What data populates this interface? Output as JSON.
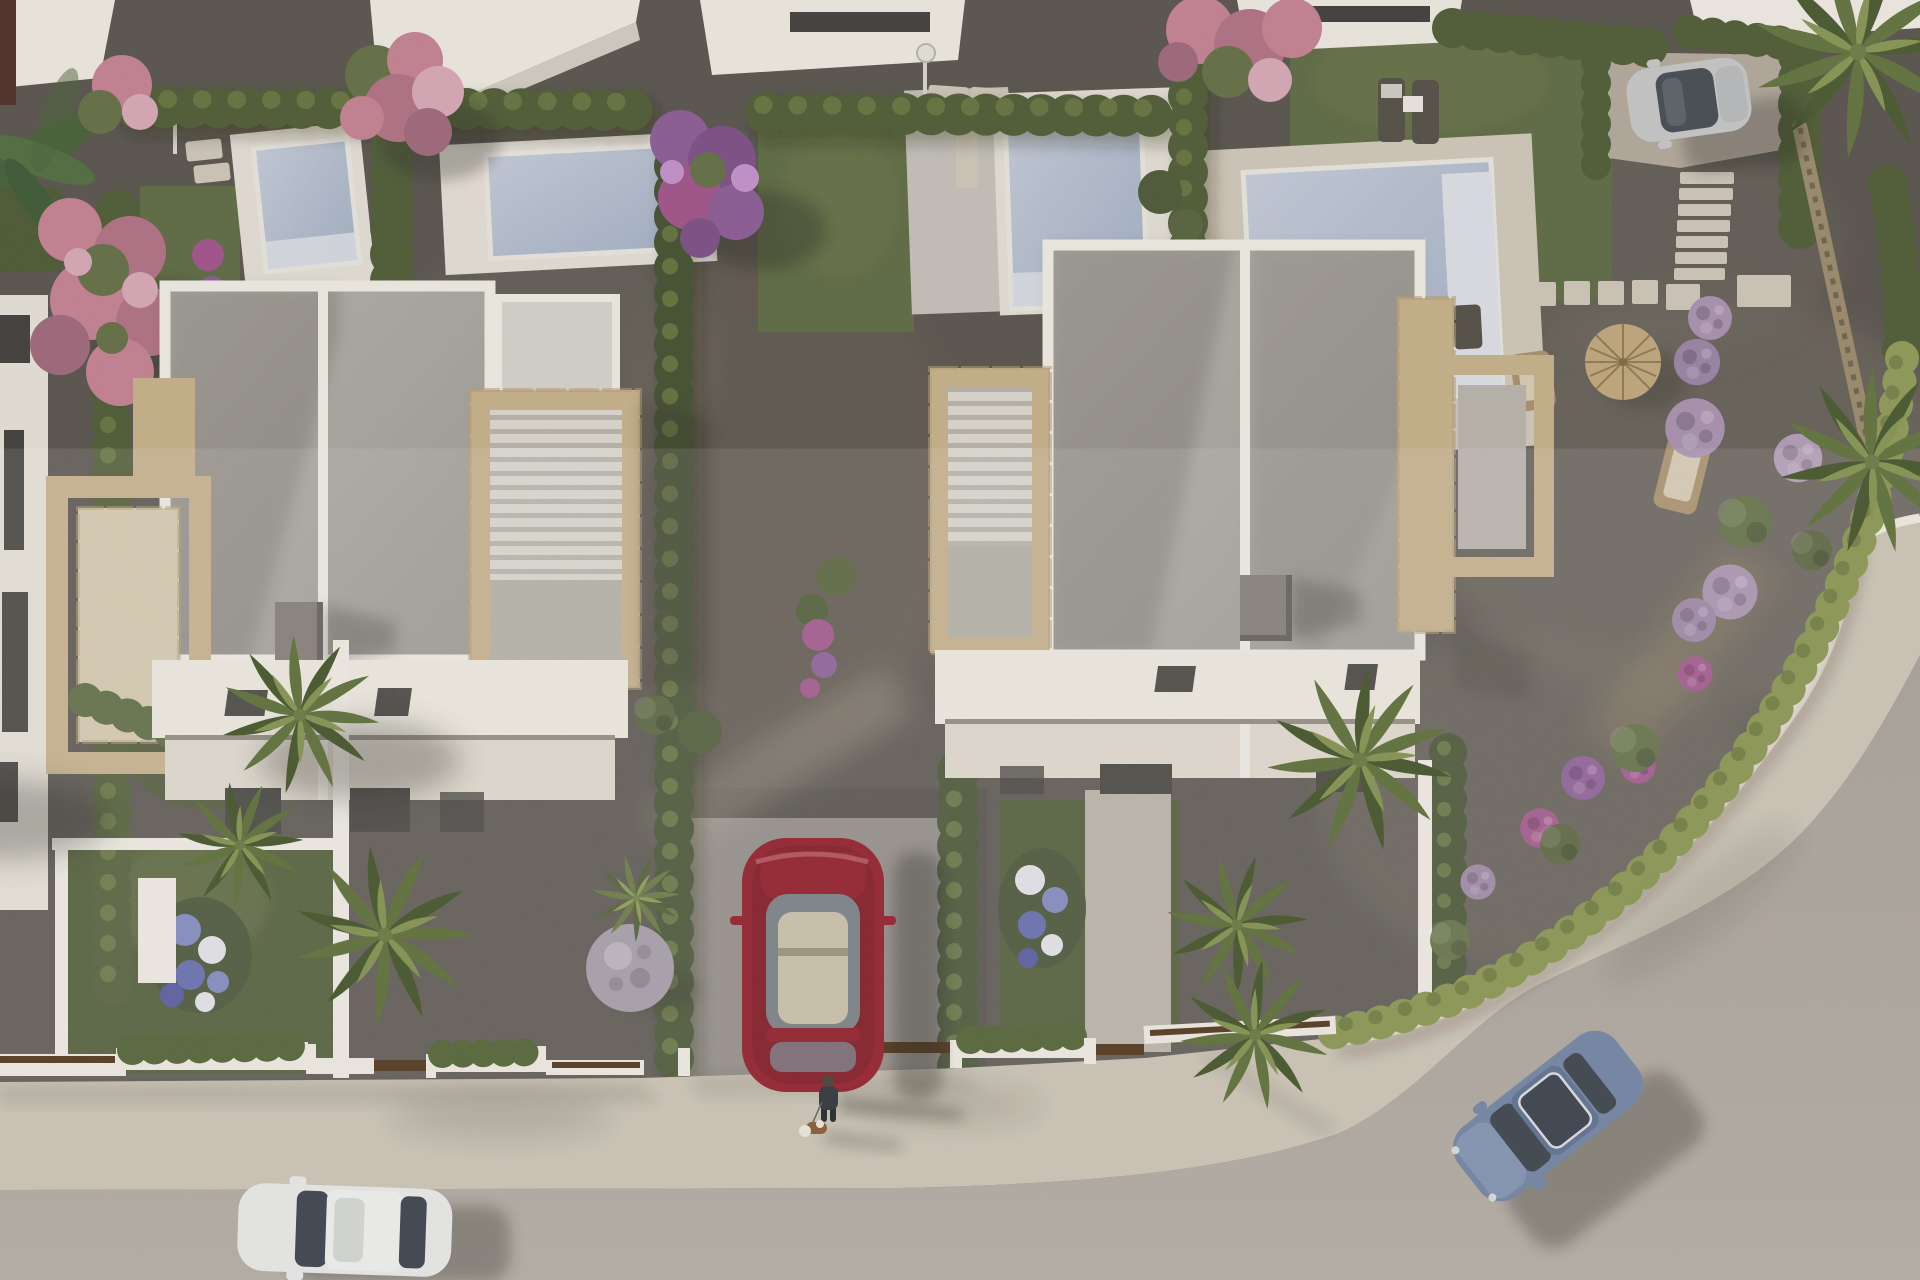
{
  "meta": {
    "title": "Aerial 3D architectural rendering of a modern villa development",
    "view": "top-down aerial, late-afternoon sun from the left, shadows cast to the right",
    "image_kind": "photorealistic CGI render, no text or UI elements visible"
  },
  "colors": {
    "gravel": "#54504a",
    "gravel_light": "#6a655c",
    "gravel_warm": "#60594e",
    "grass": "#5a683f",
    "grass_dark": "#47552f",
    "grass_light": "#6e7c49",
    "hedge": "#4a5931",
    "hedge_light": "#67793f",
    "curve_hedge": "#8d9a55",
    "cypress": "#3e4c2c",
    "deck_white": "#e7e3da",
    "deck_gray": "#c6c3bc",
    "deck_trav": "#d2cabb",
    "water": "#a2b0c6",
    "water_light": "#c6cedd",
    "water_step": "#dfe3ea",
    "wall_white": "#f4f1ea",
    "wall_shadow": "#d4cfc5",
    "roof_gravel": "#b5b2ac",
    "roof_dark": "#9b9893",
    "parapet": "#f3f0e9",
    "stone": "#c8b28a",
    "stone_light": "#dcc9a3",
    "stone_dark": "#a08b66",
    "facade": "#f2eee5",
    "terrace": "#e2dcd1",
    "glass": "#3b3a36",
    "chimney_top": "#7d7770",
    "chimney_side": "#585450",
    "road": "#aba49d",
    "road_light": "#b6b0a8",
    "sidewalk": "#cac3b4",
    "car_red": "#96212f",
    "car_red_dark": "#6e1722",
    "car_white": "#edefee",
    "car_blue": "#7387a9",
    "car_silver": "#c7c9ca",
    "glass_dark": "#3a424e",
    "interior_tan": "#cfc6b0",
    "pink": "#c67f92",
    "pink_light": "#dba9b9",
    "purple": "#8a5796",
    "lilac": "#a891b2",
    "magenta": "#a04f8a",
    "blue_flower": "#7b84c0",
    "white_flower": "#e6e6ee",
    "straw": "#c2a77b",
    "wood": "#a98f68",
    "gate_brown": "#53381f",
    "palm": "#5d7038",
    "palm_light": "#849650",
    "palm_dark": "#43552a",
    "person": "#30343d",
    "dog_brown": "#8a5c33",
    "ball_plant": "#a29aa8"
  },
  "scene": {
    "villas": [
      {
        "name": "left-villa",
        "style": "white modern flat roof, two units, gravel roof, travertine side terraces, pergola, rooftop chimney and skylights"
      },
      {
        "name": "right-villa",
        "style": "white modern flat roof, two units, gravel roof, travertine side terraces, rooftop chimney and skylights"
      }
    ],
    "pools": {
      "count": 4,
      "positions": [
        "top-left plot",
        "second top plot",
        "center-top plot",
        "top-right plot"
      ],
      "water": "light blue-grey with white steps",
      "decks": "white and travertine surrounds"
    },
    "vehicles": [
      {
        "name": "white-car",
        "state": "driving on the street, bottom-left"
      },
      {
        "name": "red-car",
        "state": "parked in central driveway between hedges"
      },
      {
        "name": "blue-car",
        "state": "driving on the curved street, bottom-right"
      },
      {
        "name": "silver-car",
        "state": "parked on driveway, top-right"
      }
    ],
    "pedestrians": [
      {
        "name": "person-walking-dog",
        "position": "sidewalk bottom-center",
        "shadow": "long, pointing right"
      }
    ],
    "vegetation": {
      "palm_trees": 8,
      "flowering_trees": [
        "pink tree top-left",
        "pink tree top-center",
        "purple tree center-top",
        "pink tree top-right"
      ],
      "hedges": "clipped boundary hedges between plots and along curved corner",
      "flower_bushes": "lilac pom-pom bushes in corner garden, blue hydrangeas in front yards, purple climbers",
      "special": [
        "silver-purple ball plant near red car",
        "banana plant top-left",
        "yucca near driveway"
      ]
    },
    "pool_accessories": [
      "two sun loungers with side table",
      "straw parasol with deck chairs",
      "outdoor pool showers",
      "stepping-stone paths and stairs"
    ],
    "street": {
      "shape": "straight along bottom, sweeping curve up the right side",
      "sidewalk": "light textured concrete behind low white walls with brown gates"
    }
  }
}
